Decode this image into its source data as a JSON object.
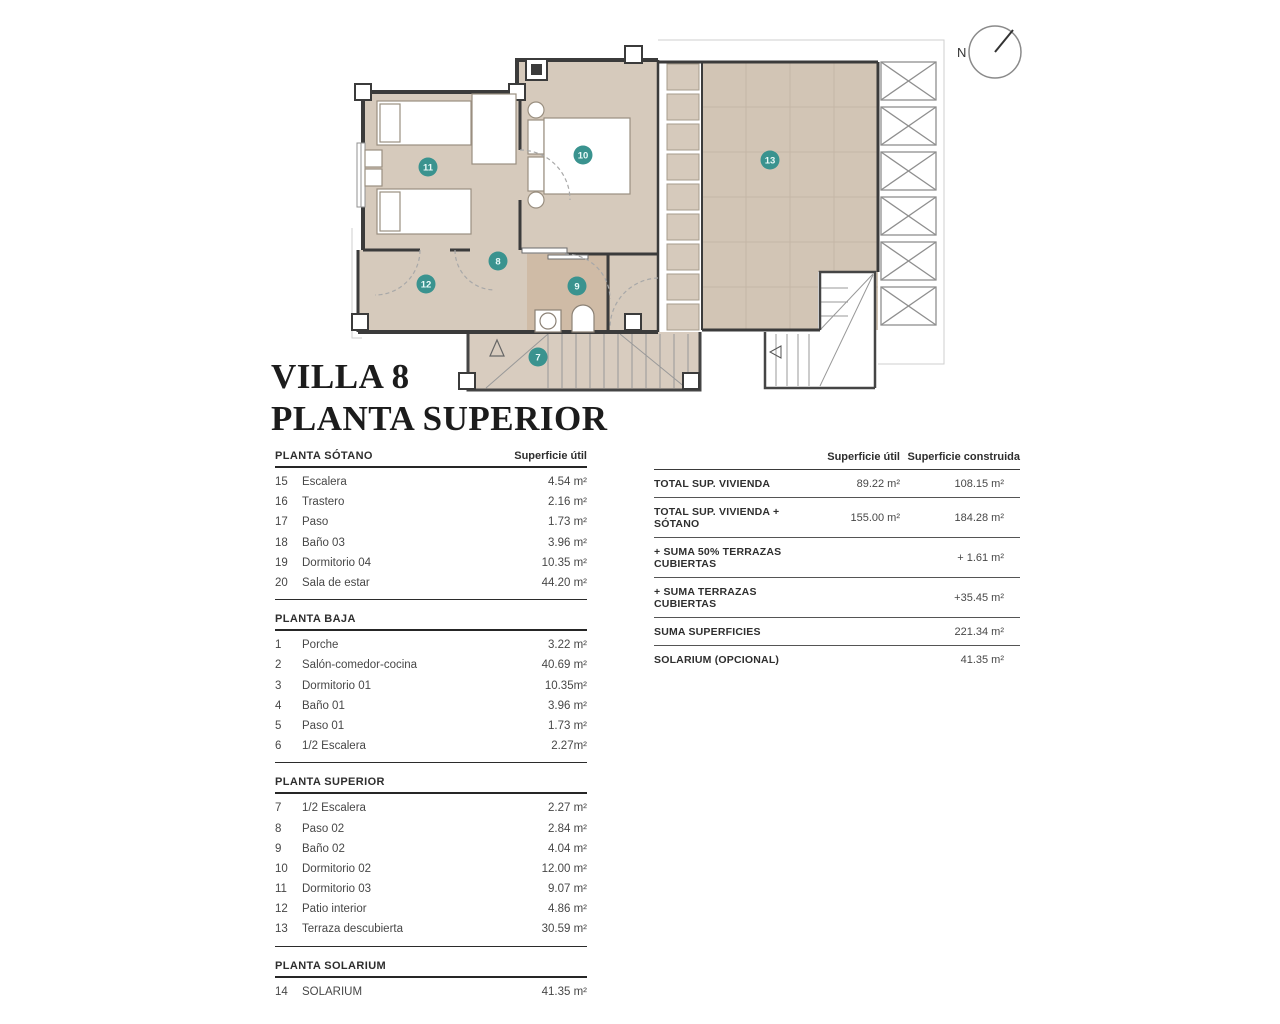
{
  "title": {
    "line1": "VILLA 8",
    "line2": "PLANTA SUPERIOR"
  },
  "left_table": {
    "area_header": "Superficie útil",
    "sections": [
      {
        "name": "PLANTA SÓTANO",
        "rows": [
          [
            "15",
            "Escalera",
            "4.54 m²"
          ],
          [
            "16",
            "Trastero",
            "2.16 m²"
          ],
          [
            "17",
            "Paso",
            "1.73 m²"
          ],
          [
            "18",
            "Baño 03",
            "3.96 m²"
          ],
          [
            "19",
            "Dormitorio 04",
            "10.35 m²"
          ],
          [
            "20",
            "Sala de estar",
            "44.20 m²"
          ]
        ]
      },
      {
        "name": "PLANTA BAJA",
        "rows": [
          [
            "1",
            "Porche",
            "3.22 m²"
          ],
          [
            "2",
            "Salón-comedor-cocina",
            "40.69 m²"
          ],
          [
            "3",
            "Dormitorio 01",
            "10.35m²"
          ],
          [
            "4",
            "Baño 01",
            "3.96 m²"
          ],
          [
            "5",
            "Paso 01",
            "1.73 m²"
          ],
          [
            "6",
            "1/2 Escalera",
            "2.27m²"
          ]
        ]
      },
      {
        "name": "PLANTA SUPERIOR",
        "rows": [
          [
            "7",
            "1/2 Escalera",
            "2.27 m²"
          ],
          [
            "8",
            "Paso 02",
            "2.84 m²"
          ],
          [
            "9",
            "Baño 02",
            "4.04 m²"
          ],
          [
            "10",
            "Dormitorio 02",
            "12.00 m²"
          ],
          [
            "11",
            "Dormitorio 03",
            "9.07 m²"
          ],
          [
            "12",
            "Patio interior",
            "4.86 m²"
          ],
          [
            "13",
            "Terraza descubierta",
            "30.59 m²"
          ]
        ]
      },
      {
        "name": "PLANTA SOLARIUM",
        "rows": [
          [
            "14",
            "SOLARIUM",
            "41.35 m²"
          ]
        ]
      }
    ]
  },
  "summary_table": {
    "col_util": "Superficie útil",
    "col_construida": "Superficie construida",
    "rows": [
      {
        "label": "TOTAL SUP. VIVIENDA",
        "util": "89.22 m²",
        "construida": "108.15 m²"
      },
      {
        "label": "TOTAL SUP. VIVIENDA + SÓTANO",
        "util": "155.00 m²",
        "construida": "184.28 m²"
      },
      {
        "label": "+ SUMA 50% TERRAZAS CUBIERTAS",
        "util": "",
        "construida": "+ 1.61 m²"
      },
      {
        "label": "+ SUMA TERRAZAS CUBIERTAS",
        "util": "",
        "construida": "+35.45 m²"
      },
      {
        "label": "SUMA SUPERFICIES",
        "util": "",
        "construida": "221.34 m²"
      },
      {
        "label": "SOLARIUM (OPCIONAL)",
        "util": "",
        "construida": "41.35 m²"
      }
    ]
  },
  "plan": {
    "compass_label": "N",
    "badges": {
      "b7": "7",
      "b8": "8",
      "b9": "9",
      "b10": "10",
      "b11": "11",
      "b12": "12",
      "b13": "13"
    },
    "colors": {
      "floor": "#d6cabc",
      "bath": "#cfbba6",
      "terrace": "#d2c5b5",
      "wall": "#3b3b3b",
      "badge": "#3a938f"
    }
  }
}
